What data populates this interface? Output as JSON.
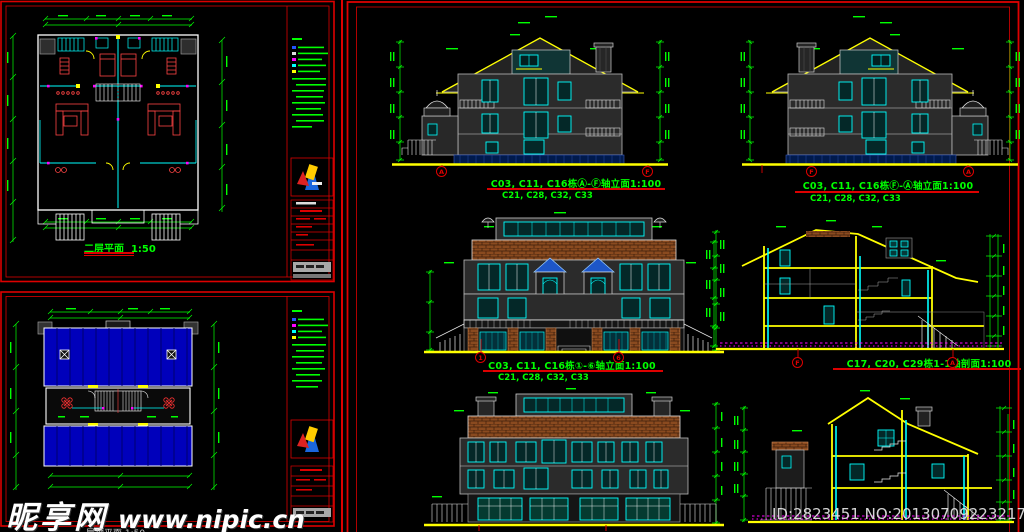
{
  "colors": {
    "background": "#000000",
    "sheet_border_red": "#dd0000",
    "dimension_green": "#00ff00",
    "wall_cyan": "#00ffff",
    "ground_yellow": "#ffff00",
    "roof_tile_brown": "#8a4a1f",
    "roof_plan_blue": "#0000bb",
    "furniture_red": "#ff4444",
    "hatch_magenta": "#ff00ff",
    "watermark_white": "#ffffff"
  },
  "left_top_sheet": {
    "plan_label": "二层平面",
    "plan_scale": "1:50"
  },
  "left_bottom_sheet": {
    "plan_label_partial": "屋顶平面 1:50"
  },
  "right_sheet": {
    "drawings": [
      {
        "title": "C03, C11, C16栋Ⓐ-Ⓕ轴立面1:100",
        "subtitle": "C21, C28, C32, C33",
        "bubble_left": "A",
        "bubble_right": "F"
      },
      {
        "title": "C03, C11, C16栋Ⓕ-Ⓐ轴立面1:100",
        "subtitle": "C21, C28, C32, C33",
        "bubble_left": "F",
        "bubble_right": "A"
      },
      {
        "title": "C03, C11, C16栋①-⑥轴立面1:100",
        "subtitle": "C21, C28, C32, C33",
        "bubble_left": "1",
        "bubble_right": "6"
      },
      {
        "title": "C17, C20, C29栋1-1轴剖面1:100",
        "subtitle": "",
        "bubble_left": "F",
        "bubble_right": "A"
      }
    ]
  },
  "watermark": {
    "brand": "昵享网",
    "url": "www.nipic.cn",
    "id_text": "ID:2823451 NO:20130709223217819000"
  }
}
